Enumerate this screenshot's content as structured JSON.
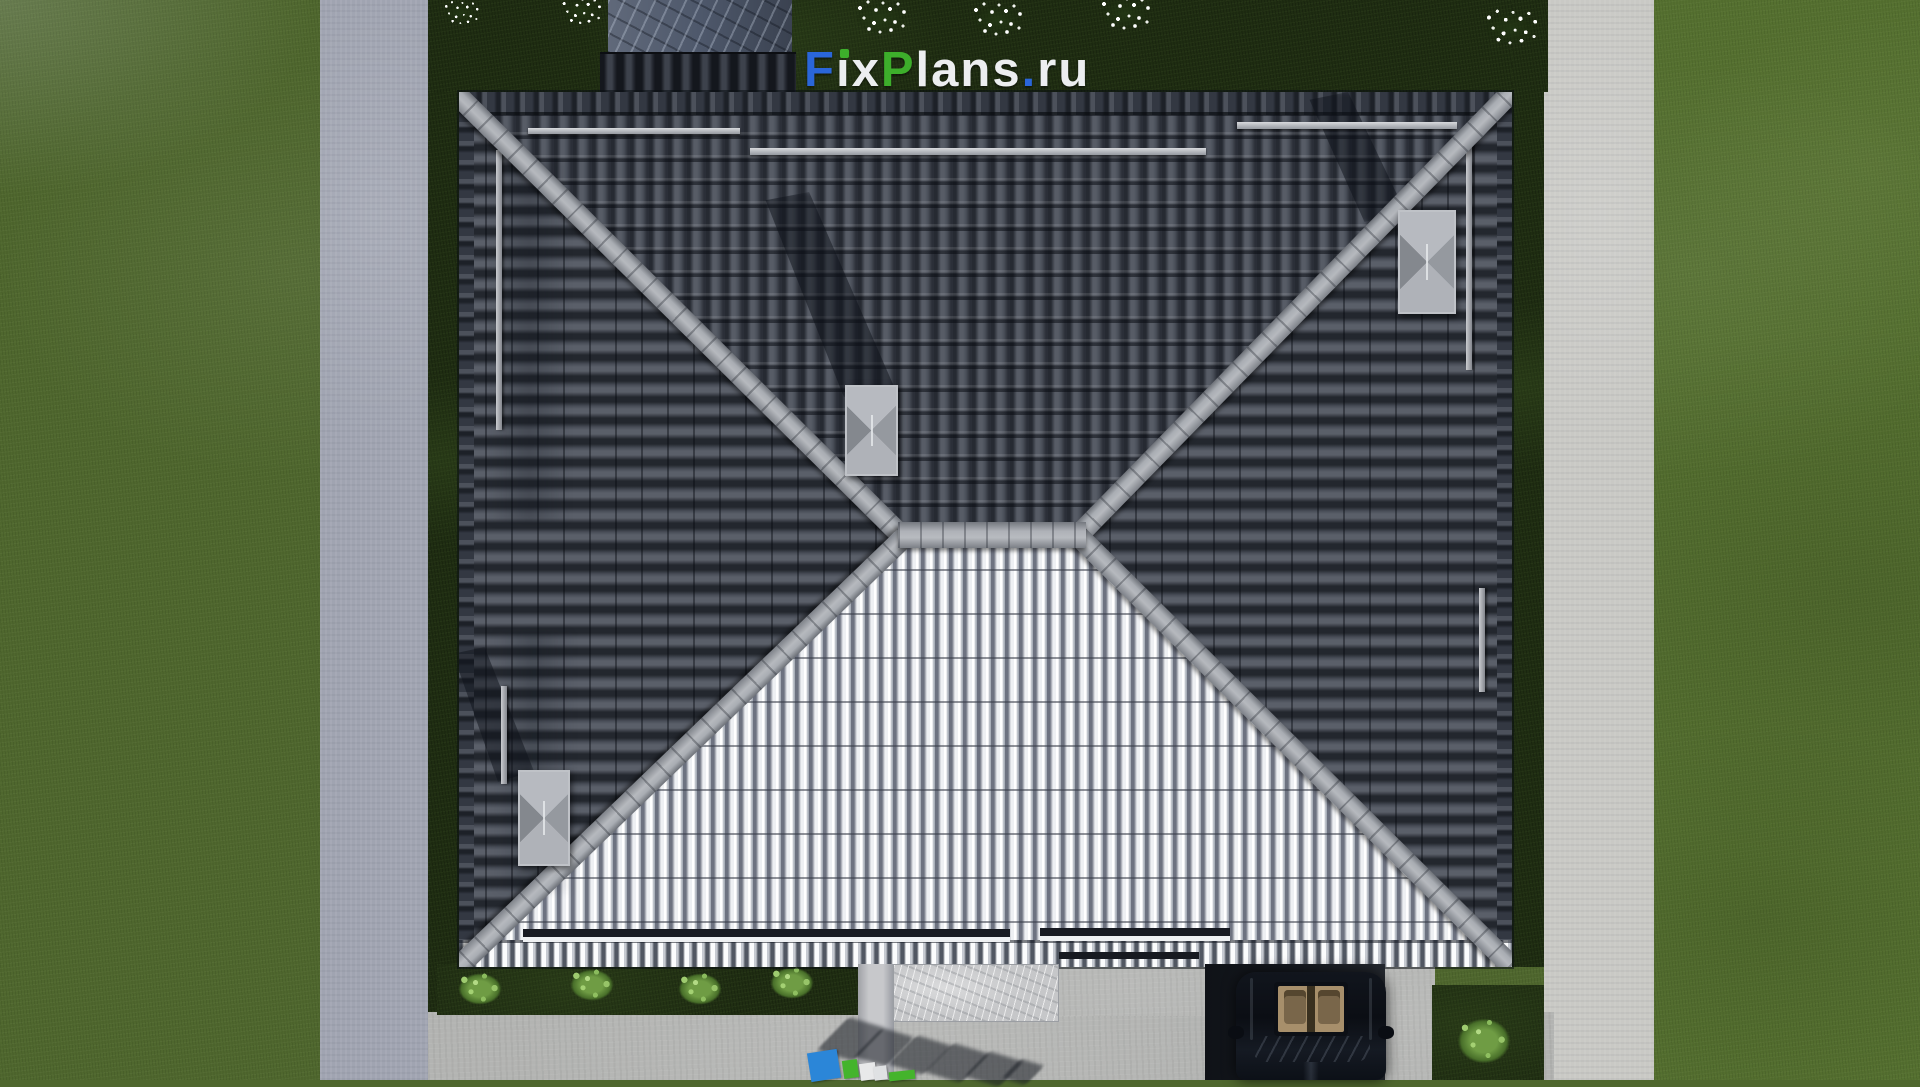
{
  "scene": {
    "type": "top-down 3d architectural render",
    "subject": "hip-roof house with lawn, walkways, driveway and parked car"
  },
  "watermark": {
    "text": "FixPlans.ru",
    "letters": [
      {
        "ch": "F",
        "color": "blue"
      },
      {
        "ch": "i",
        "color": "white",
        "dot": "green"
      },
      {
        "ch": "x",
        "color": "white"
      },
      {
        "ch": "P",
        "color": "green"
      },
      {
        "ch": "l",
        "color": "white"
      },
      {
        "ch": "a",
        "color": "white"
      },
      {
        "ch": "n",
        "color": "white"
      },
      {
        "ch": "s",
        "color": "white"
      },
      {
        "ch": ".",
        "color": "blue"
      },
      {
        "ch": "r",
        "color": "white"
      },
      {
        "ch": "u",
        "color": "white"
      }
    ],
    "colors": {
      "blue": "#2a66d9",
      "green": "#3dae2b",
      "white": "#eceef0"
    }
  },
  "ground_sign": {
    "blocks": [
      {
        "color": "#2b86d8"
      },
      {
        "color": "#44b42c"
      },
      {
        "color": "#e8e9ea"
      },
      {
        "color": "#dfe1e3"
      },
      {
        "color": "#44b42c"
      }
    ]
  },
  "palette": {
    "grass": "#4f672e",
    "grass_shadow": "#1f2d12",
    "path_left": "#a0a4b1",
    "path_right": "#c9c9c5",
    "concrete": "#b3b4b2",
    "roof_dark_tile": "#40454e",
    "roof_light_tile": "#cdd0d6",
    "ridge_cap": "#aeb1b7",
    "chimney": "#a2a5aa",
    "car_body": "#0b0e14",
    "car_interior": "#a78f6b"
  }
}
